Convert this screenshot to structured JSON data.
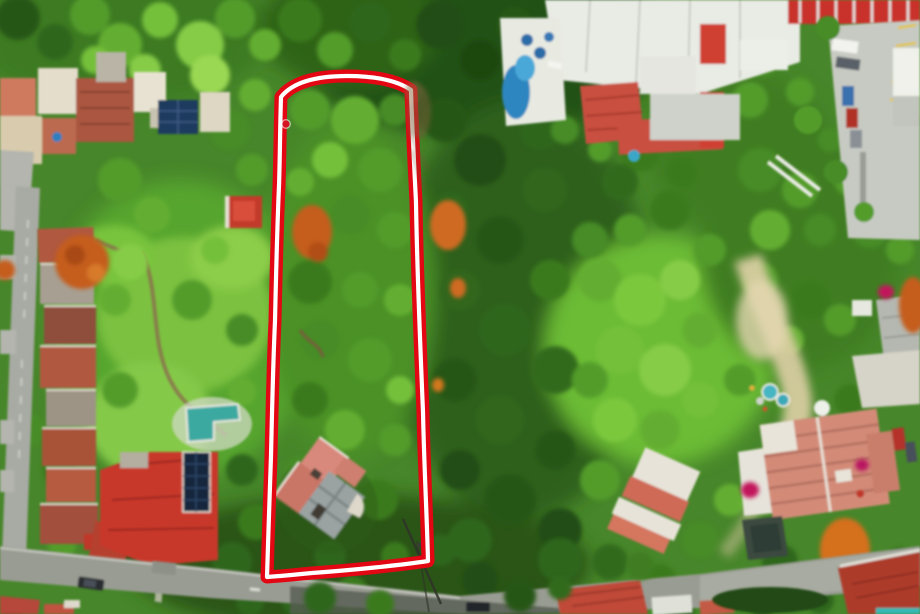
{
  "meta": {
    "title": "Aerial drone photograph of a long wooded land parcel outlined in red among residential houses and streets",
    "image_width": 920,
    "image_height": 614,
    "visible_text": "none"
  },
  "scene": {
    "setting": "top-down drone view over dense tropical tree canopy, terracotta-roofed houses, pools, streets and a marked property boundary",
    "parcel": {
      "marker_color": "#e30613",
      "marker_inner_stripe": "#ffffff",
      "shape": "elongated rectangle with arched top edge",
      "approx_bounds": {
        "top_left": [
          281,
          97
        ],
        "top_right": [
          411,
          90
        ],
        "bottom_right": [
          428,
          561
        ],
        "bottom_left": [
          267,
          577
        ]
      },
      "marker_dot": {
        "x": 286,
        "y": 124,
        "color": "#d41420"
      },
      "contains": [
        "dense tree canopy",
        "orange flowering trees",
        "house with pink roof and round turret"
      ]
    },
    "landmarks": [
      "top-left cluster of beige and terracotta roofed houses with small blue pool and dark skylight panels",
      "vertical residential street along left edge with row of terracotta roofs",
      "bright lawn garden with winding dirt path and L-shaped turquoise pool",
      "large red-roofed house with rooftop solar panel array near bottom left",
      "white industrial roofs, red corrugated roof and concrete parking lot with cars at top right",
      "curvy blue pool with blue umbrellas on white terrace at top center",
      "sandy clearing, two small round pools and large salmon-roofed house at bottom right",
      "diagonal street across the bottom with cars and red roofs below it",
      "utility pole shadow crossing the parcel's bottom-right corner"
    ]
  },
  "palette": {
    "canopy_dark": "#224e12",
    "canopy_mid": "#478c26",
    "canopy_bright": "#7cc83e",
    "lawn": "#7cc141",
    "roof_terracotta": "#b0593f",
    "roof_red": "#c8372b",
    "roof_salmon": "#d38b78",
    "pool_teal": "#3aa9a0",
    "pool_blue": "#2d86c0",
    "street_gray": "#a8aaa4",
    "concrete": "#c9ccc4",
    "solar_panel": "#16263e",
    "flowering_orange": "#c55d1f",
    "bougainvillea": "#c2185b",
    "outline_red": "#e30613",
    "outline_stripe": "#ffffff"
  }
}
